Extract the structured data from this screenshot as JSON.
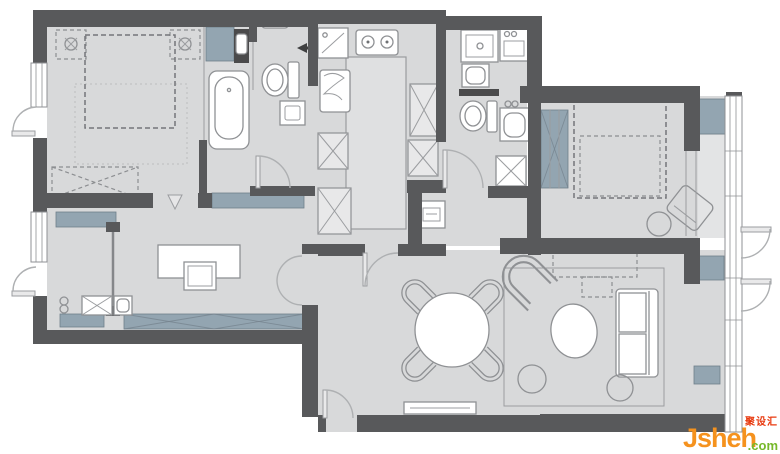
{
  "palette": {
    "wall": "#58595b",
    "floor": "#d8d9da",
    "floor_light": "#e3e4e5",
    "island": "#dfe0e1",
    "accent": "#93a5b1",
    "counter": "#4a4a4b",
    "outline": "#8f9194"
  },
  "watermark": {
    "brand": "Jsheh",
    "tld": ".com",
    "badge": "聚设汇",
    "brand_color": "#f5921e",
    "tld_color": "#76b82a",
    "badge_color": "#e8380d"
  },
  "rooms": [
    {
      "name": "master-bedroom"
    },
    {
      "name": "bathroom-with-tub"
    },
    {
      "name": "wc-laundry"
    },
    {
      "name": "kitchen"
    },
    {
      "name": "bathroom-2"
    },
    {
      "name": "hallway"
    },
    {
      "name": "bedroom-2"
    },
    {
      "name": "study-entry"
    },
    {
      "name": "dining-area"
    },
    {
      "name": "living-room"
    },
    {
      "name": "balcony"
    }
  ]
}
